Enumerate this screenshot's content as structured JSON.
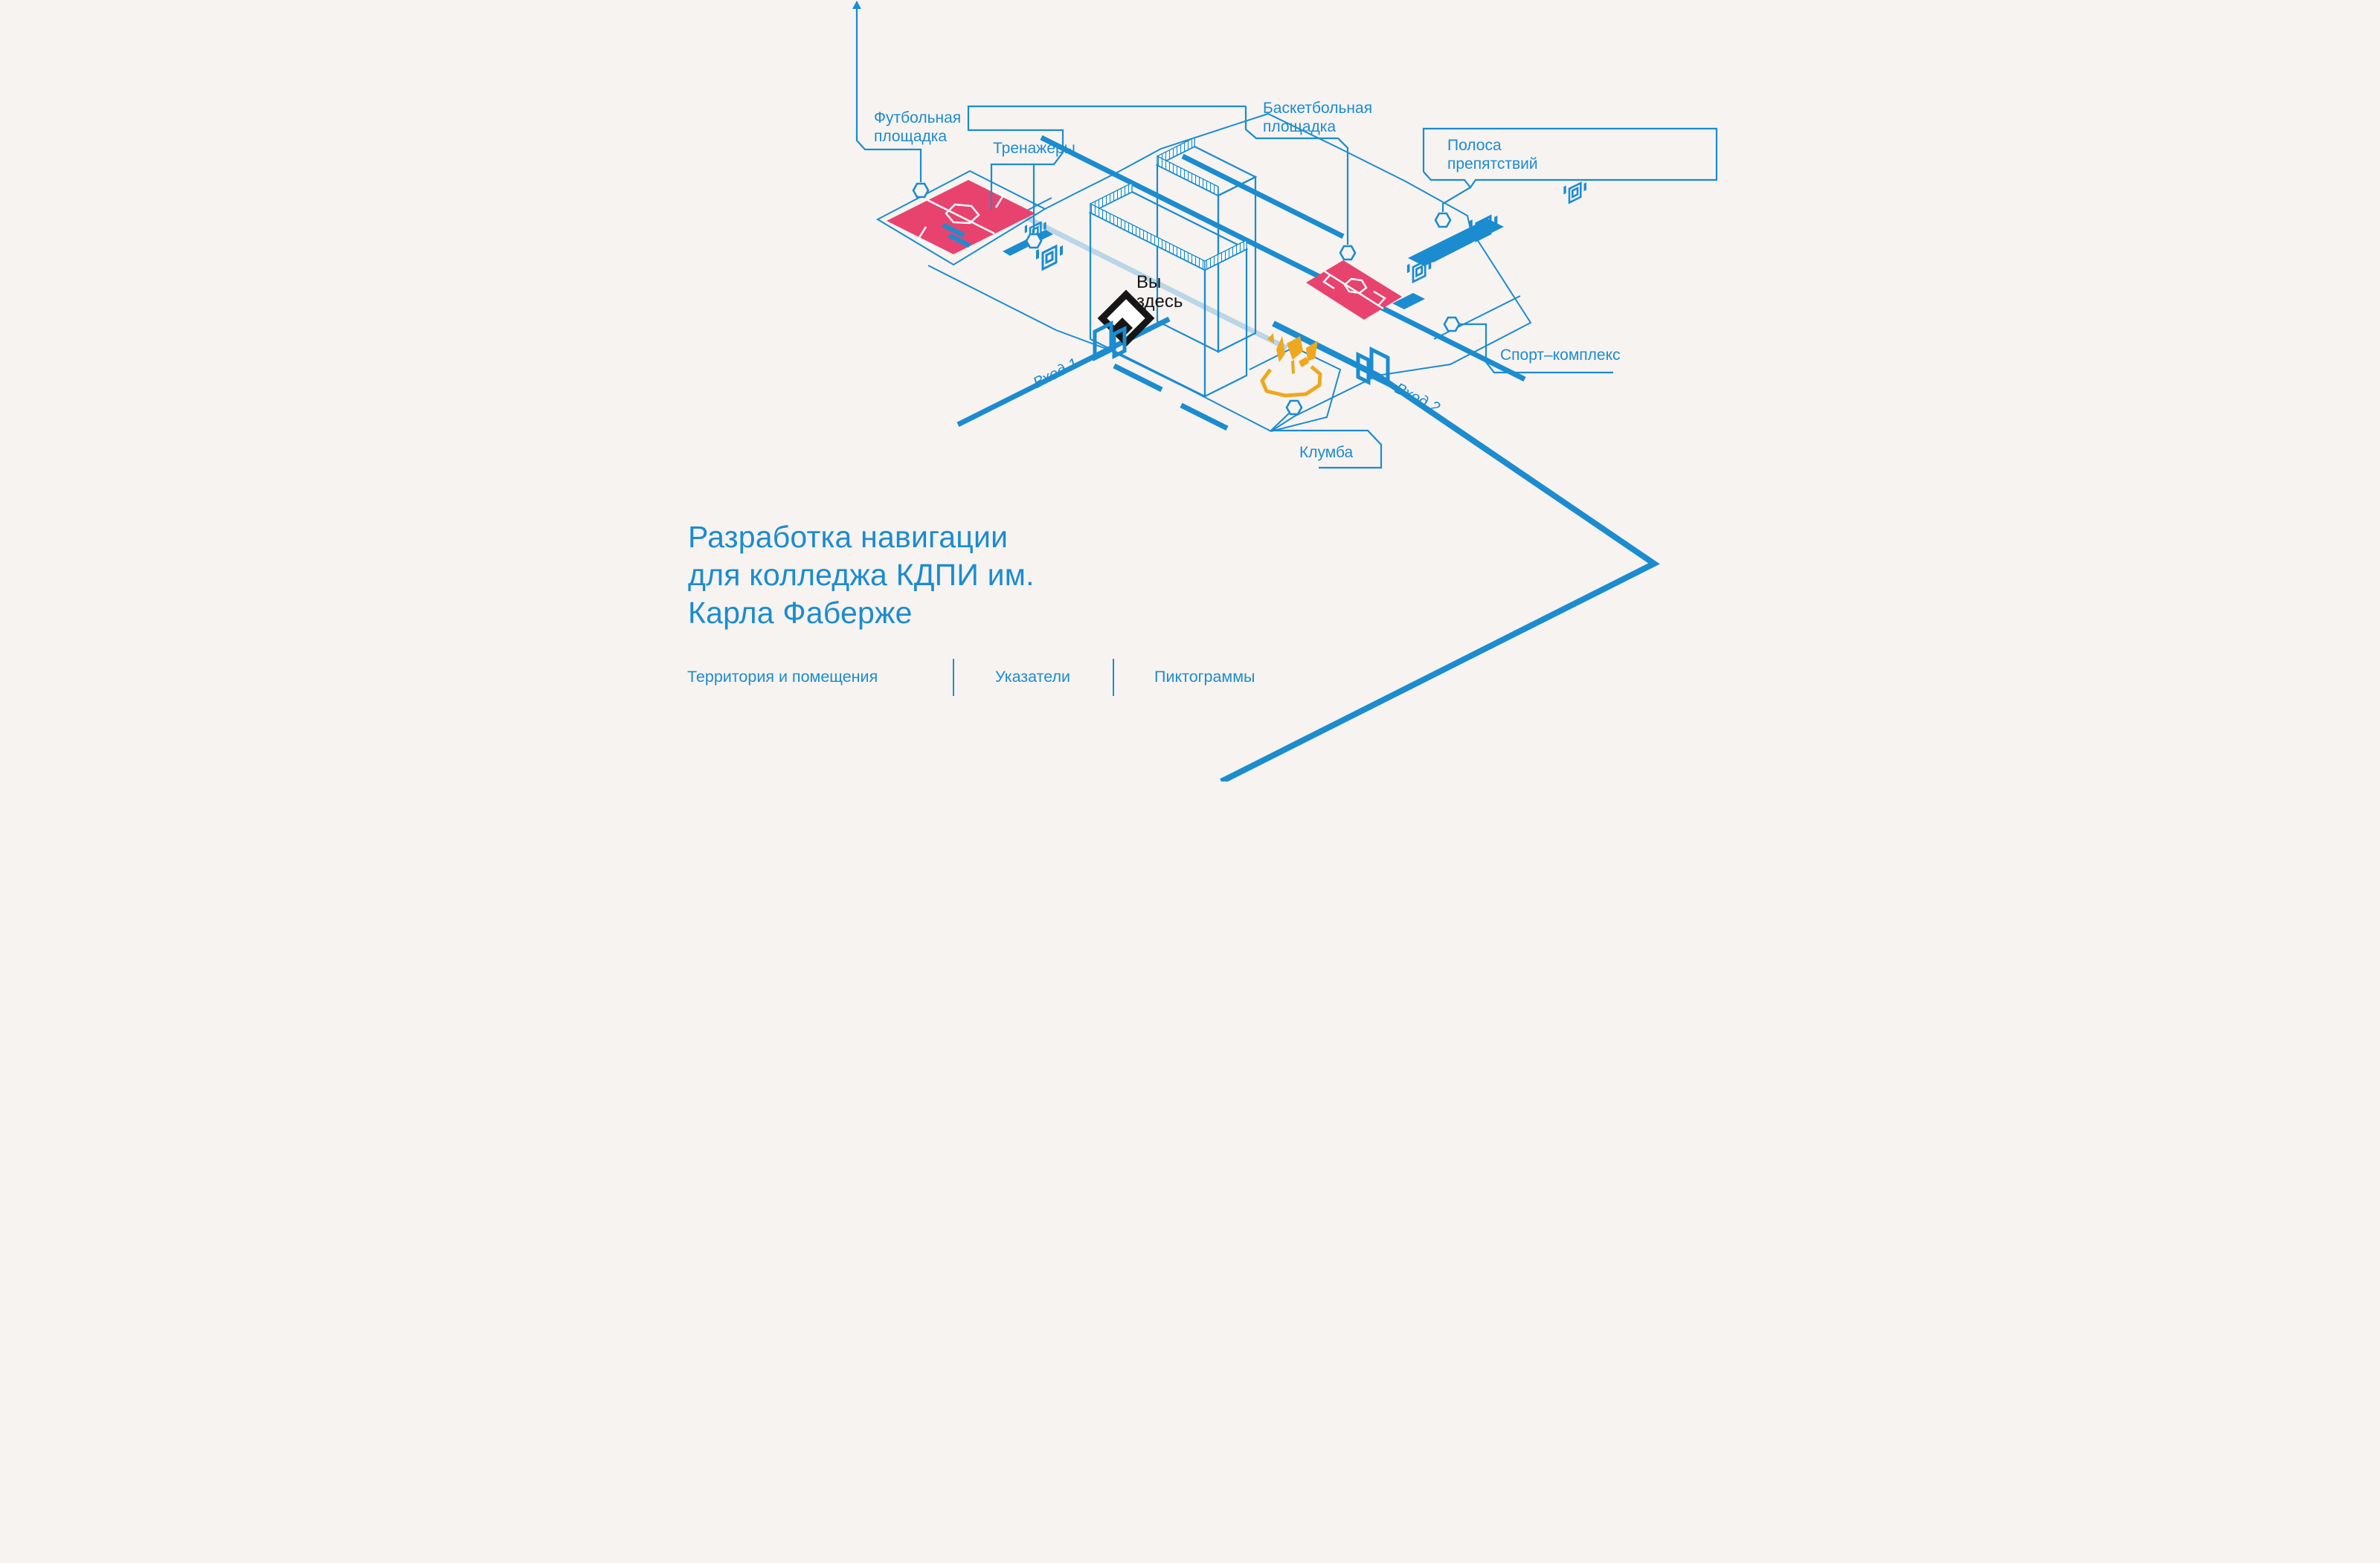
{
  "page": {
    "title_lines": [
      "Разработка навигации",
      "для колледжа КДПИ им.",
      "Карла Фаберже"
    ]
  },
  "tabs": [
    {
      "label": "Территория  и помещения"
    },
    {
      "label": "Указатели"
    },
    {
      "label": "Пиктограммы"
    }
  ],
  "map": {
    "marker": {
      "line1": "Вы",
      "line2": "здесь"
    },
    "labels": {
      "football": [
        "Футбольная",
        "площадка"
      ],
      "gym": "Тренажёры",
      "basketball": [
        "Баскетбольная",
        "площадка"
      ],
      "obstacle": [
        "Полоса",
        "препятствий"
      ],
      "sport": "Спорт–комплекс",
      "flowerbed": "Клумба",
      "entrance1": "Вход 1",
      "entrance2": "Вход 2"
    },
    "icons": {
      "point_node": "hexagon-marker-icon",
      "you_are_here": "black-diamond-marker-icon",
      "entrance": "gate-icon",
      "equipment": "fitness-tower-icon",
      "flowerbed": "flower-icon",
      "direction": "arrow-up-icon"
    }
  },
  "colors": {
    "accent": "#1b8cd0",
    "pink": "#e8436f",
    "yellow": "#eda81f",
    "ink": "#161616",
    "background": "#f7f3f0"
  }
}
